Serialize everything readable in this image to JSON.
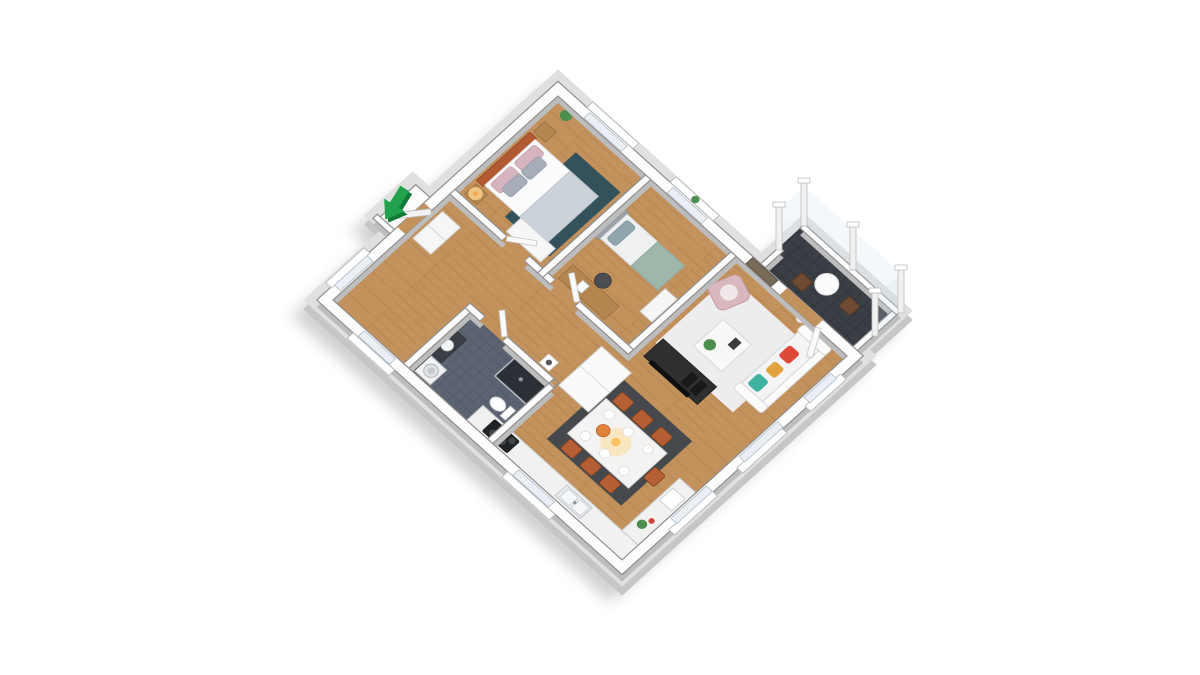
{
  "scene": {
    "title": "3D isometric floor plan render – two-bedroom apartment with balcony",
    "background": "#ffffff",
    "entrance_arrow": {
      "name": "entrance-arrow",
      "points_to": "apartment entrance door on north-west wall",
      "color_main": "#23a24e",
      "color_shade": "#0f7a38"
    }
  },
  "palette": {
    "wood": "#c2915c",
    "wood-line": "#a67943",
    "wall-top": "#fdfdfd",
    "wall-side": "#bdbdbd",
    "wall-line": "#8f8f8f",
    "slab-top": "#e0e0e0",
    "slab-side": "#c6c6c6",
    "shadow": "#8d8d8d",
    "tile-bath": "#5c6472",
    "tile-bath-line": "#49505f",
    "tile-balcony": "#3a3e45",
    "tile-balcony-line": "#2b2e33",
    "rug-living": "#ededf0",
    "rug-dining": "#45494d",
    "rug-bed": "#33525c",
    "sofa": "#f4f4f6",
    "pillow-red": "#de4a38",
    "pillow-mustard": "#e2a33e",
    "pillow-teal": "#3fb3a0",
    "armchair": "#d9b7be",
    "chair-rust": "#b65f35",
    "headboard": "#b25a32",
    "furn-wood": "#b5854f",
    "tv-dark": "#2d2f31",
    "plant": "#4c8f4e",
    "glow": "#ffd98f",
    "glass": "#e9eff4",
    "white-furn": "#f6f6f6"
  },
  "rooms": [
    {
      "id": "entrance-hall",
      "name": "Entrance hall",
      "floor": "wood",
      "furniture": [
        "entry door",
        "hall closet"
      ]
    },
    {
      "id": "bedroom-primary",
      "name": "Bedroom 1 (double bed)",
      "floor": "wood",
      "furniture": [
        "double bed",
        "two nightstands",
        "bedside lamp",
        "wardrobe",
        "dark teal rug"
      ]
    },
    {
      "id": "bedroom-secondary",
      "name": "Bedroom 2 (single bed)",
      "floor": "wood",
      "furniture": [
        "single bed",
        "desk",
        "desk chair",
        "dresser",
        "window plant"
      ]
    },
    {
      "id": "bathroom",
      "name": "Bathroom",
      "floor": "dark tile",
      "furniture": [
        "washing machine",
        "vanity with basin",
        "toilet",
        "walk-in shower"
      ]
    },
    {
      "id": "kitchen-dining",
      "name": "Kitchen / dining",
      "floor": "wood",
      "furniture": [
        "L-shaped counter",
        "cooktop",
        "double sink",
        "tall cabinets",
        "coffee stool",
        "dining table for 7",
        "rust dining chairs",
        "pendant glow",
        "dark grey rug"
      ]
    },
    {
      "id": "living-room",
      "name": "Living room",
      "floor": "wood",
      "furniture": [
        "sofa with red, mustard and teal cushions",
        "coffee table with plant",
        "pink armchair",
        "tv console with tv",
        "floor lamp",
        "wall art",
        "light rug"
      ]
    },
    {
      "id": "balcony",
      "name": "Balcony",
      "floor": "dark tile",
      "furniture": [
        "round bistro table",
        "two wooden chairs",
        "glass railing with posts"
      ]
    }
  ],
  "openings": {
    "entrance_door": "north-west wall",
    "balcony_door": "north-east wall of living room",
    "window_count": 8
  }
}
